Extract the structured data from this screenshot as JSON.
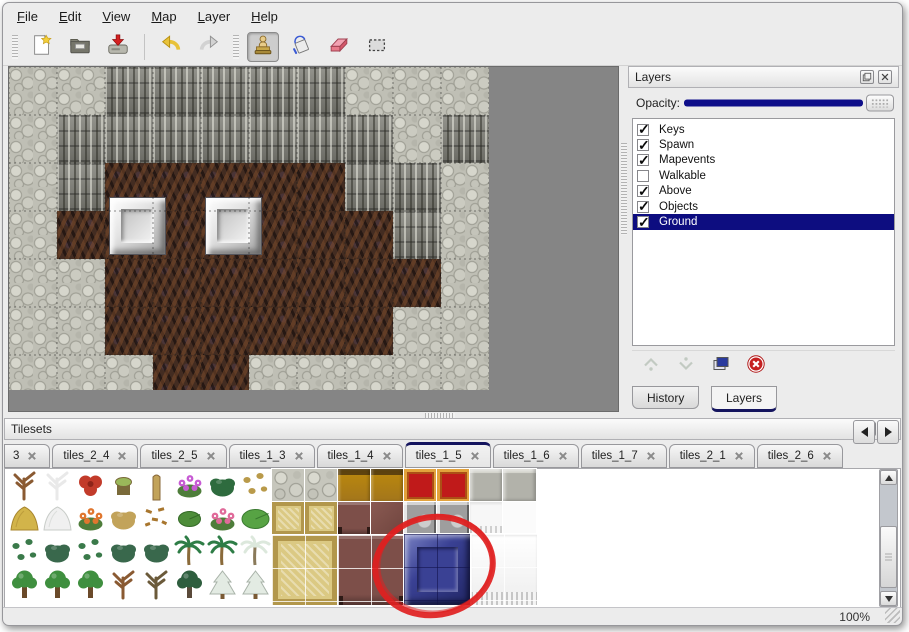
{
  "window": {
    "bg": "#ececec",
    "accent_navy": "#0d0d80"
  },
  "menu_bar": {
    "items": [
      {
        "label": "File"
      },
      {
        "label": "Edit"
      },
      {
        "label": "View"
      },
      {
        "label": "Map"
      },
      {
        "label": "Layer"
      },
      {
        "label": "Help"
      }
    ]
  },
  "toolbar": {
    "buttons": [
      {
        "name": "new",
        "icon": "new-file-icon",
        "group_start": true
      },
      {
        "name": "open",
        "icon": "open-folder-icon"
      },
      {
        "name": "save",
        "icon": "save-icon"
      },
      {
        "name": "undo",
        "icon": "undo-icon",
        "sep_before": true
      },
      {
        "name": "redo",
        "icon": "redo-icon"
      },
      {
        "name": "stamp",
        "icon": "stamp-tool-icon",
        "group_start": true,
        "active": true
      },
      {
        "name": "fill",
        "icon": "fill-bucket-icon"
      },
      {
        "name": "eraser",
        "icon": "eraser-icon"
      },
      {
        "name": "select",
        "icon": "select-rect-icon"
      }
    ]
  },
  "map_view": {
    "tile_size": 48,
    "rows": [
      "LLDDDDDLLL",
      "LDDDDDDDLD",
      "LDGGGGGDDL",
      "LGGGGGGGDL",
      "LLGGGGGGGL",
      "LLGGGGGGLL",
      "LLLGGLLLLL"
    ],
    "legend": {
      "L": "light-rock",
      "D": "cliff-wall",
      "G": "cave-floor"
    },
    "blocks": [
      {
        "x": 100,
        "y": 130,
        "w": 57,
        "h": 58,
        "kind": "silver-block"
      },
      {
        "x": 196,
        "y": 130,
        "w": 57,
        "h": 58,
        "kind": "silver-block"
      }
    ],
    "colors": {
      "light_rock": "#bfbfb5",
      "cliff": "#82827a",
      "floor": "#432c21",
      "canvas_bg": "#858585"
    }
  },
  "layers_panel": {
    "title": "Layers",
    "opacity_label": "Opacity:",
    "opacity_value": 100,
    "layers": [
      {
        "label": "Keys",
        "checked": true,
        "selected": false
      },
      {
        "label": "Spawn",
        "checked": true,
        "selected": false
      },
      {
        "label": "Mapevents",
        "checked": true,
        "selected": false
      },
      {
        "label": "Walkable",
        "checked": false,
        "selected": false
      },
      {
        "label": "Above",
        "checked": true,
        "selected": false
      },
      {
        "label": "Objects",
        "checked": true,
        "selected": false
      },
      {
        "label": "Ground",
        "checked": true,
        "selected": true
      }
    ],
    "actions": [
      {
        "name": "raise-layer",
        "icon": "chevron-up-icon",
        "enabled": false
      },
      {
        "name": "lower-layer",
        "icon": "chevron-down-icon",
        "enabled": false
      },
      {
        "name": "duplicate-layer",
        "icon": "copy-icon",
        "enabled": true
      },
      {
        "name": "delete-layer",
        "icon": "delete-icon",
        "enabled": true
      }
    ],
    "bottom_tabs": [
      {
        "label": "History",
        "active": false
      },
      {
        "label": "Layers",
        "active": true
      }
    ]
  },
  "tilesets_panel": {
    "title": "Tilesets",
    "tabs": [
      {
        "label": "3",
        "clipped": true
      },
      {
        "label": "tiles_2_4"
      },
      {
        "label": "tiles_2_5"
      },
      {
        "label": "tiles_1_3"
      },
      {
        "label": "tiles_1_4"
      },
      {
        "label": "tiles_1_5",
        "active": true
      },
      {
        "label": "tiles_1_6"
      },
      {
        "label": "tiles_1_7"
      },
      {
        "label": "tiles_2_1"
      },
      {
        "label": "tiles_2_6"
      }
    ],
    "sprite_grid": [
      [
        "bare_tree",
        "snow_tree",
        "red_bloom",
        "stump",
        "trunk",
        "purple_flowers",
        "fern",
        "small_plant"
      ],
      [
        "hay_mound",
        "snow_mound",
        "orange_flowers",
        "dry_tuft",
        "leaves",
        "lily_pad",
        "pink_flowers",
        "lily_pad_large"
      ],
      [
        "sprigs",
        "bush",
        "sprigs",
        "bush",
        "bush",
        "palm",
        "palm",
        "snow_palm"
      ],
      [
        "green_tree",
        "green_tree",
        "green_tree",
        "bare_tree",
        "dead_tree",
        "dark_tree",
        "snow_pine",
        "snow_pine"
      ]
    ],
    "sprite_palette": {
      "bare_tree": [
        "#8a5a32",
        "#6b4526"
      ],
      "snow_tree": [
        "#e9e9e9",
        "#c9cdc9"
      ],
      "red_bloom": [
        "#c23b2a",
        "#8e2418"
      ],
      "stump": [
        "#9ab85a",
        "#7a6a3a"
      ],
      "trunk": [
        "#c2a35a",
        "#8a6a3a"
      ],
      "purple_flowers": [
        "#c75bd4",
        "#4e7d3a"
      ],
      "fern": [
        "#2e6b3e",
        "#1e4b2e"
      ],
      "small_plant": [
        "#b99a4a",
        "#8a6a3a"
      ],
      "hay_mound": [
        "#d2b44a",
        "#a8862e"
      ],
      "snow_mound": [
        "#f0f0f0",
        "#c8ccc8"
      ],
      "orange_flowers": [
        "#e0762e",
        "#4e7d3a"
      ],
      "dry_tuft": [
        "#c2a35a",
        "#9a7a3a"
      ],
      "leaves": [
        "#a8762e",
        "#7a521e"
      ],
      "lily_pad": [
        "#4e8d3a",
        "#356a28"
      ],
      "pink_flowers": [
        "#e06a9a",
        "#4e7d3a"
      ],
      "lily_pad_large": [
        "#57a344",
        "#3a7a30"
      ],
      "sprigs": [
        "#3a7a4a",
        "#2a5a36"
      ],
      "bush": [
        "#39684c",
        "#24493a"
      ],
      "palm": [
        "#2e7d46",
        "#8a6a3a"
      ],
      "snow_palm": [
        "#dce8dc",
        "#8a7a5a"
      ],
      "green_tree": [
        "#3f8f3f",
        "#6b4a2a"
      ],
      "dead_tree": [
        "#6b5a3a",
        "#4a3e28"
      ],
      "dark_tree": [
        "#2e5e3e",
        "#5a4a3a"
      ],
      "snow_pine": [
        "#e3ebe3",
        "#a9b3a9"
      ]
    },
    "furniture": [
      {
        "x": 267,
        "y": 0,
        "w": 33,
        "h": 33,
        "kind": "cobble"
      },
      {
        "x": 300,
        "y": 0,
        "w": 33,
        "h": 33,
        "kind": "cobble"
      },
      {
        "x": 333,
        "y": 0,
        "w": 33,
        "h": 33,
        "kind": "wood_top"
      },
      {
        "x": 366,
        "y": 0,
        "w": 33,
        "h": 33,
        "kind": "wood_top"
      },
      {
        "x": 399,
        "y": 0,
        "w": 33,
        "h": 33,
        "kind": "red_carpet"
      },
      {
        "x": 432,
        "y": 0,
        "w": 33,
        "h": 33,
        "kind": "red_carpet"
      },
      {
        "x": 465,
        "y": 0,
        "w": 33,
        "h": 33,
        "kind": "gray_tile"
      },
      {
        "x": 498,
        "y": 0,
        "w": 33,
        "h": 33,
        "kind": "gray_tile"
      },
      {
        "x": 267,
        "y": 33,
        "w": 33,
        "h": 33,
        "kind": "gold_carpet"
      },
      {
        "x": 300,
        "y": 33,
        "w": 33,
        "h": 33,
        "kind": "gold_carpet"
      },
      {
        "x": 333,
        "y": 33,
        "w": 33,
        "h": 33,
        "kind": "stool"
      },
      {
        "x": 366,
        "y": 33,
        "w": 33,
        "h": 33,
        "kind": "brown_tile"
      },
      {
        "x": 399,
        "y": 33,
        "w": 33,
        "h": 33,
        "kind": "silver_struct"
      },
      {
        "x": 432,
        "y": 33,
        "w": 33,
        "h": 33,
        "kind": "silver_struct"
      },
      {
        "x": 465,
        "y": 33,
        "w": 33,
        "h": 33,
        "kind": "white_fringe"
      },
      {
        "x": 498,
        "y": 33,
        "w": 33,
        "h": 33,
        "kind": "white_plain"
      },
      {
        "x": 267,
        "y": 66,
        "w": 66,
        "h": 70,
        "kind": "gold_carpet_big",
        "cross": "light"
      },
      {
        "x": 333,
        "y": 66,
        "w": 66,
        "h": 70,
        "kind": "brown_big",
        "cross": "light"
      },
      {
        "x": 399,
        "y": 65,
        "w": 67,
        "h": 71,
        "kind": "blue_block",
        "cross": "dark"
      },
      {
        "x": 466,
        "y": 65,
        "w": 66,
        "h": 71,
        "kind": "white_curtain",
        "cross": "light"
      }
    ],
    "annotation": {
      "type": "red-circle",
      "cx": 429,
      "cy": 97,
      "rx": 59,
      "ry": 49,
      "color": "#e02020"
    }
  },
  "status_bar": {
    "zoom_level": "100%"
  }
}
